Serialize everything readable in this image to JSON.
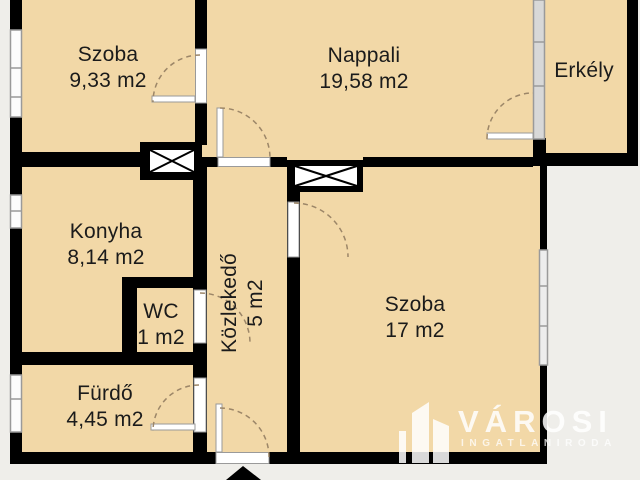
{
  "plan": {
    "rooms": {
      "szoba1": {
        "name": "Szoba",
        "area": "9,33 m2"
      },
      "nappali": {
        "name": "Nappali",
        "area": "19,58 m2"
      },
      "erkely": {
        "name": "Erkély"
      },
      "konyha": {
        "name": "Konyha",
        "area": "8,14 m2"
      },
      "wc": {
        "name": "WC",
        "area": "1 m2"
      },
      "kozlekedo": {
        "name": "Közlekedő",
        "area": "5 m2"
      },
      "furdo": {
        "name": "Fürdő",
        "area": "4,45 m2"
      },
      "szoba2": {
        "name": "Szoba",
        "area": "17 m2"
      }
    },
    "watermark": {
      "brand": "VÁROSI",
      "tagline": "INGATLANIRODA"
    },
    "colors": {
      "floor": "#f2d8a7",
      "outside": "#efeeea",
      "wall": "#000000",
      "label_text": "#1b1b1b",
      "door_arc": "#9c8668",
      "window_frame": "#9a9a9a",
      "watermark": "#ffffff"
    }
  }
}
